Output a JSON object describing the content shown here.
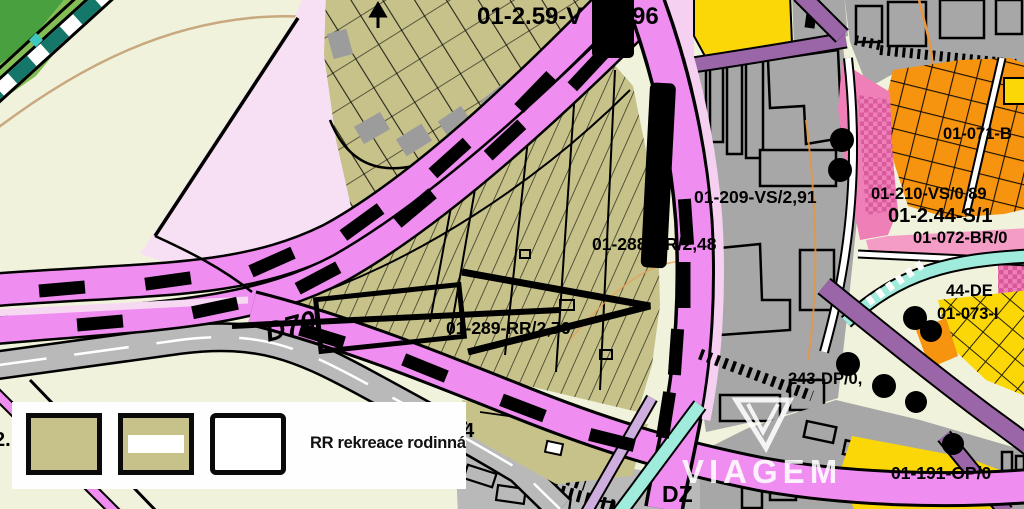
{
  "map": {
    "labels": [
      {
        "text": "01-2.59-V"
      },
      {
        "text": "3,96"
      },
      {
        "text": "01-288-RR/2,48"
      },
      {
        "text": "01-289-RR/2,76"
      },
      {
        "text": "01-209-VS/2,91"
      },
      {
        "text": "01-210-VS/0,89"
      },
      {
        "text": "01-2.44-S/1"
      },
      {
        "text": "01-072-BR/0"
      },
      {
        "text": "01-071-B"
      },
      {
        "text": "44-DE"
      },
      {
        "text": "01-073-I"
      },
      {
        "text": "243-DP/0,"
      },
      {
        "text": "01-191-OP/0"
      },
      {
        "text": "D70"
      },
      {
        "text": "DZ"
      },
      {
        "text": "54"
      },
      {
        "text": "2."
      }
    ]
  },
  "legend": {
    "title": "RR rekreace rodinná",
    "swatches": [
      {
        "name": "rr-zone-solid",
        "color": "#c6c28a"
      },
      {
        "name": "rr-zone-striped",
        "color": "#c6c28a",
        "stripe": "#ffffff"
      },
      {
        "name": "rr-zone-outline",
        "color": "#ffffff"
      }
    ]
  },
  "watermark": {
    "brand": "VIAGEM"
  },
  "colors": {
    "background": "#f1f2dc",
    "zone_rr_olive": "#c6c28a",
    "road_pink": "#ef8df1",
    "road_pale_pink": "#f8ddf3",
    "built_gray": "#a7a7a7",
    "road_gray": "#b9b9b9",
    "zone_yellow": "#fbd708",
    "zone_orange": "#f6930f",
    "zone_rose": "#ef7fb7",
    "road_purple": "#9a66a8",
    "road_cyan": "#9fecdc",
    "rail_green": "#15776a",
    "contour_tan": "#c8a87e",
    "contour_orange": "#e8973f",
    "black": "#000000"
  }
}
